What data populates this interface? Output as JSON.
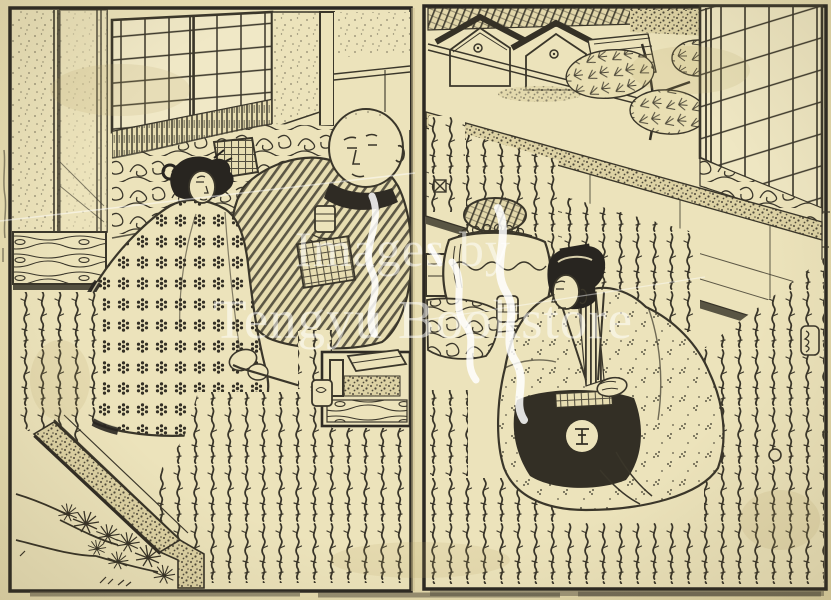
{
  "artwork": {
    "kind": "Scanned two-page spread of an Edo-period woodblock-printed illustrated book",
    "paper_color": "#ece3bb",
    "ink_color": "#3a362a",
    "heavy_ink_color": "#282520"
  },
  "watermark": {
    "line1": "Images by",
    "line2": "Tengyu Bookstore",
    "color": "#ffffff"
  },
  "pages": {
    "left": {
      "elements": [
        "folding-screen",
        "shoji-window",
        "cloud-patterned-bedding",
        "box-pillow",
        "seated-man-shaved-head",
        "teacup",
        "woman-in-polka-dot-kimono",
        "kiseru-pipe",
        "tobacco-tray-table",
        "veranda-edge",
        "pine-branches",
        "calligraphy-columns",
        "section-marker"
      ]
    },
    "right": {
      "elements": [
        "garden-storehouses",
        "pine-trees",
        "perspective-wall",
        "shoji-screen",
        "wave-patterned-band",
        "brazier-with-kettle",
        "teacup",
        "sake-cup-stand",
        "seated-man-crested-kimono",
        "calligraphy-columns",
        "label-cartouche",
        "section-marker",
        "circle-marker"
      ]
    }
  },
  "markers": {
    "section_marker": "⊠",
    "circle_marker": "〇"
  }
}
